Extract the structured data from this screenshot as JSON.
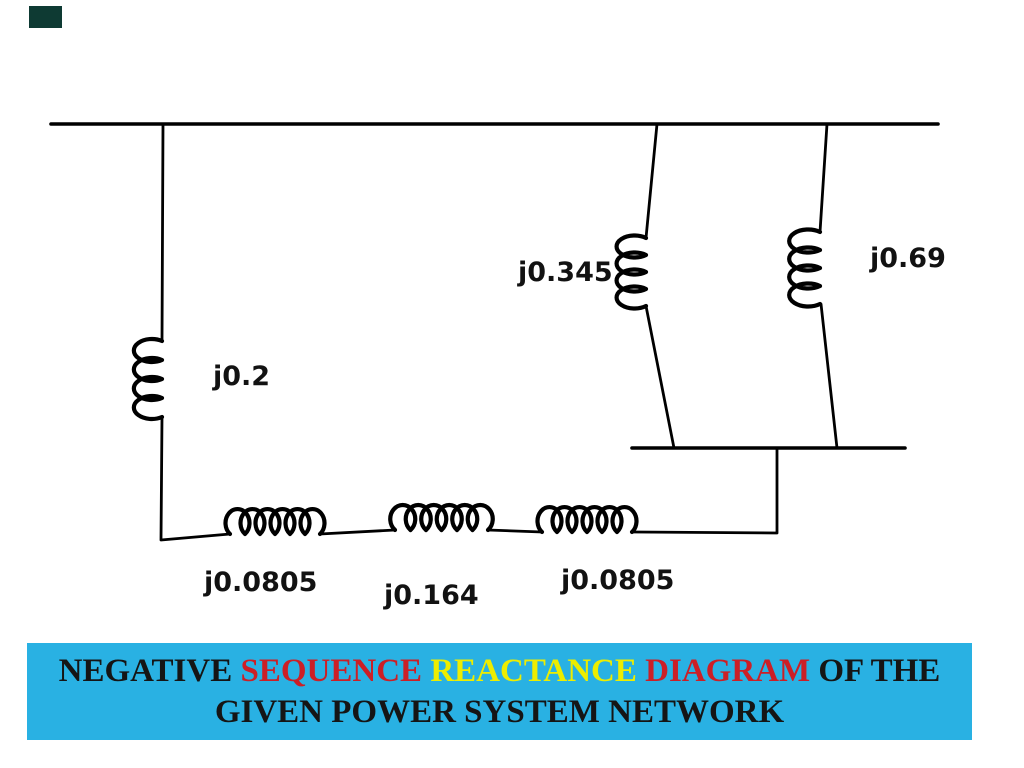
{
  "slide": {
    "kind": "power-system-reactance-diagram"
  },
  "decor": {
    "corner_block_color": "#0e3a33"
  },
  "diagram": {
    "line_color": "#000000",
    "inductors": [
      {
        "id": "left-branch",
        "label": "j0.2"
      },
      {
        "id": "middle-branch",
        "label": "j0.345"
      },
      {
        "id": "right-branch",
        "label": "j0.69"
      },
      {
        "id": "series-line-left",
        "label": "j0.0805"
      },
      {
        "id": "series-line-middle",
        "label": "j0.164"
      },
      {
        "id": "series-line-right",
        "label": "j0.0805"
      }
    ]
  },
  "banner": {
    "background": "#29b1e3",
    "line1_segments": [
      {
        "text": "NEGATIVE ",
        "color": "#151515"
      },
      {
        "text": "SEQUENCE ",
        "color": "#cc1f26"
      },
      {
        "text": "REACTANCE ",
        "color": "#eded00"
      },
      {
        "text": "DIAGRAM ",
        "color": "#cc1f26"
      },
      {
        "text": "OF THE",
        "color": "#151515"
      }
    ],
    "line2": {
      "text": "GIVEN POWER SYSTEM NETWORK",
      "color": "#151515"
    }
  }
}
